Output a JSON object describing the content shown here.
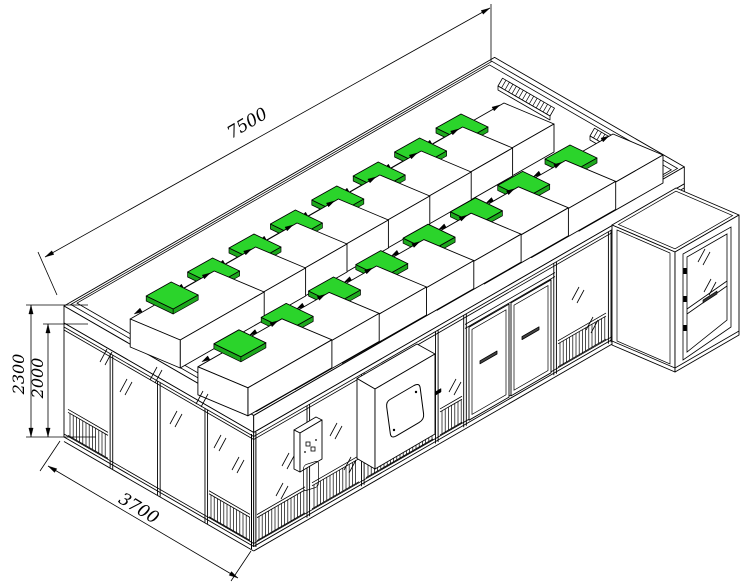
{
  "drawing": {
    "type": "isometric technical drawing",
    "subject": "modular clean room with ceiling fan filter units",
    "background": "#ffffff",
    "line_color": "#000000"
  },
  "dimensions": {
    "length": "7500",
    "width": "3700",
    "overall_height": "2300",
    "wall_height": "2000"
  },
  "colors": {
    "hepa_filter_top": "#2bd42b",
    "hepa_filter_side": "#1da81d"
  },
  "roof": {
    "ffu_count": 16,
    "ffu_rows": 2,
    "ffu_per_row": 8,
    "light_rail_count": 2
  },
  "walls": {
    "left_glass_panels": 4,
    "left_return_grilles": 2,
    "front_glass_panels": 4,
    "front_return_grilles": 5,
    "door_leaves": 2,
    "door_handles": 2
  },
  "equipment": {
    "pass_box": "pass box with rounded viewing window",
    "control_panel": "wall mounted control panel",
    "air_shower": "entry module with glazed hinged door"
  }
}
